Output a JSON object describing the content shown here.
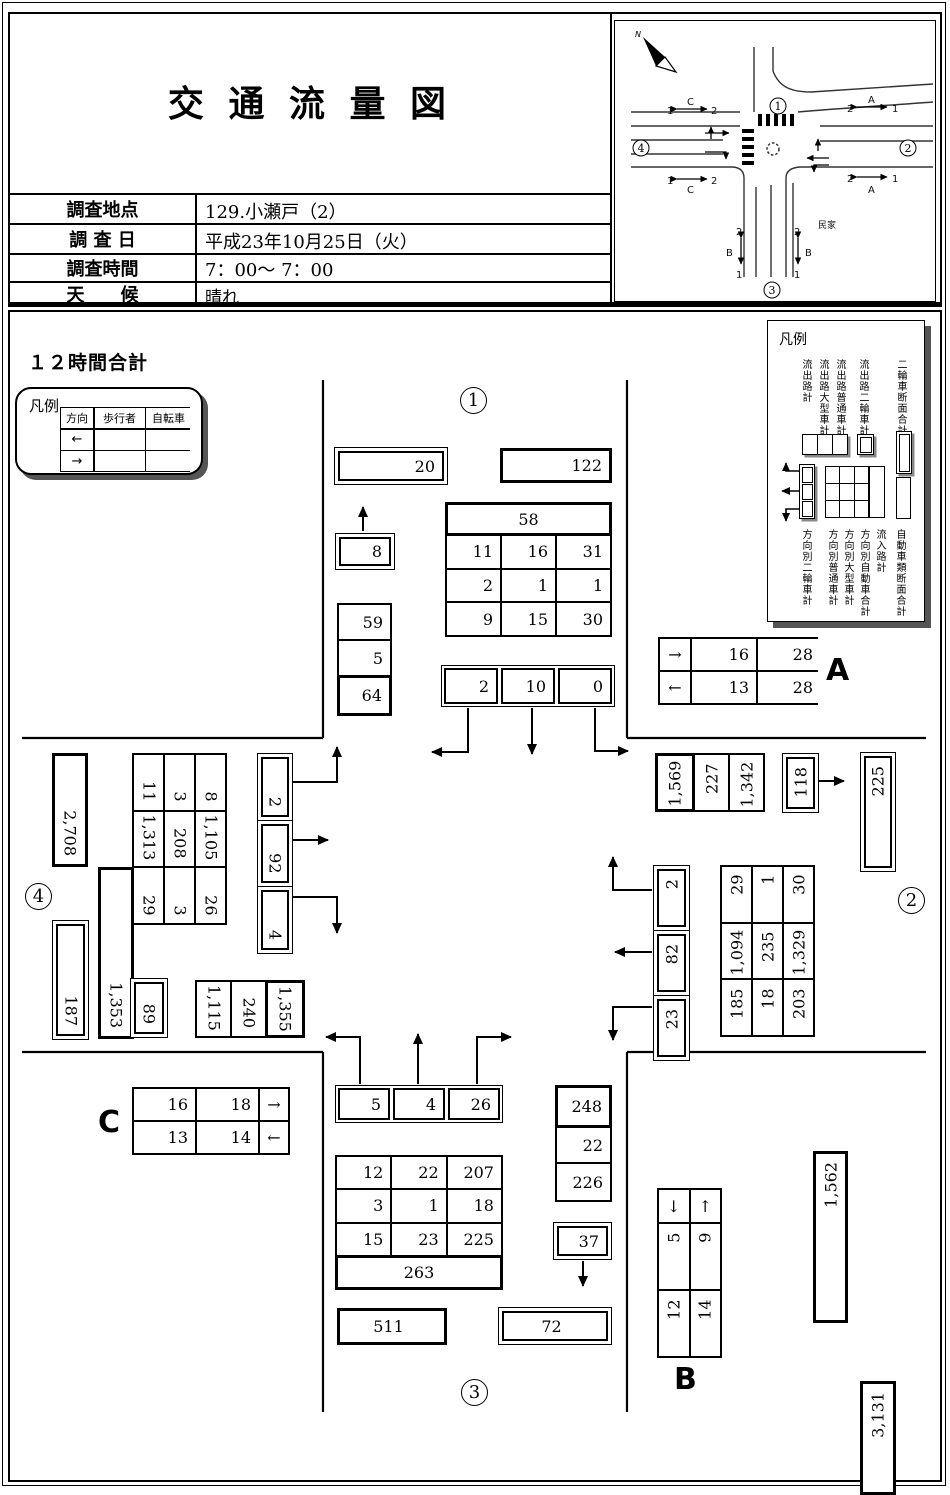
{
  "header": {
    "title": "交 通 流 量 図",
    "rows": [
      {
        "label": "調査地点",
        "value": "129.小瀬戸（2）"
      },
      {
        "label": "調 査 日",
        "value": "平成23年10月25日（火）"
      },
      {
        "label": "調査時間",
        "value": "7：00～ 7：00"
      },
      {
        "label": "天　　候",
        "value": "晴れ"
      }
    ]
  },
  "map": {
    "north": "N",
    "n1": "1",
    "n2": "2",
    "n3": "3",
    "n4": "4",
    "a": "A",
    "b": "B",
    "c": "C",
    "lane1": "1",
    "lane2": "2",
    "house": "民家"
  },
  "summary_title": "１２時間合計",
  "legend_left": {
    "title": "凡例",
    "col_headers": [
      "方向",
      "歩行者",
      "自転車"
    ],
    "row_dirs": [
      "←",
      "→"
    ]
  },
  "legend_right": {
    "title": "凡例",
    "top_labels": [
      "流出路計",
      "流出路大型車計",
      "流出路普通車計",
      "流出路二輪車計",
      "二輪車断面合計"
    ],
    "bottom_labels": [
      "方向別二輪車計",
      "方向別普通車計",
      "方向別大型車計",
      "方向別自動車合計",
      "流入路計",
      "自動車類断面合計"
    ]
  },
  "north_leg": {
    "label": "1",
    "moto_section": "20",
    "auto_section": "122",
    "moto_out": "8",
    "in_total": "58",
    "grid": [
      [
        "11",
        "16",
        "31"
      ],
      [
        "2",
        "1",
        "1"
      ],
      [
        "9",
        "15",
        "30"
      ]
    ],
    "out_stack": [
      "59",
      "5",
      "64"
    ],
    "dir": [
      "2",
      "10",
      "0"
    ]
  },
  "east_leg": {
    "label": "2",
    "out_group": [
      "1,569",
      "227",
      "1,342"
    ],
    "moto_out": "118",
    "moto_section": "225",
    "dir": [
      "2",
      "82",
      "23"
    ],
    "grid": [
      [
        "29",
        "1",
        "30"
      ],
      [
        "1,094",
        "235",
        "1,329"
      ],
      [
        "185",
        "18",
        "203"
      ]
    ],
    "in_total": "1,562",
    "auto_section": "3,131"
  },
  "south_leg": {
    "label": "3",
    "dir": [
      "5",
      "4",
      "26"
    ],
    "grid": [
      [
        "12",
        "22",
        "207"
      ],
      [
        "3",
        "1",
        "18"
      ],
      [
        "15",
        "23",
        "225"
      ]
    ],
    "in_total": "263",
    "out_total": "511",
    "out_stack": [
      "248",
      "22",
      "226"
    ],
    "moto_out": "37",
    "moto_section": "72"
  },
  "west_leg": {
    "label": "4",
    "auto_section": "2,708",
    "in_total": "1,353",
    "grid": [
      [
        "11",
        "3",
        "8"
      ],
      [
        "1,313",
        "208",
        "1,105"
      ],
      [
        "29",
        "3",
        "26"
      ]
    ],
    "moto_section": "187",
    "moto_out": "89",
    "out_group": [
      "1,115",
      "240",
      "1,355"
    ],
    "dir": [
      "2",
      "92",
      "4"
    ]
  },
  "table_a": {
    "label": "A",
    "rows": [
      [
        "→",
        "16",
        "28"
      ],
      [
        "←",
        "13",
        "28"
      ]
    ]
  },
  "table_b": {
    "label": "B",
    "arrows": [
      "↓",
      "↑"
    ],
    "rows": [
      [
        "5",
        "9"
      ],
      [
        "12",
        "14"
      ]
    ]
  },
  "table_c": {
    "label": "C",
    "rows": [
      [
        "16",
        "18",
        "→"
      ],
      [
        "13",
        "14",
        "←"
      ]
    ]
  }
}
